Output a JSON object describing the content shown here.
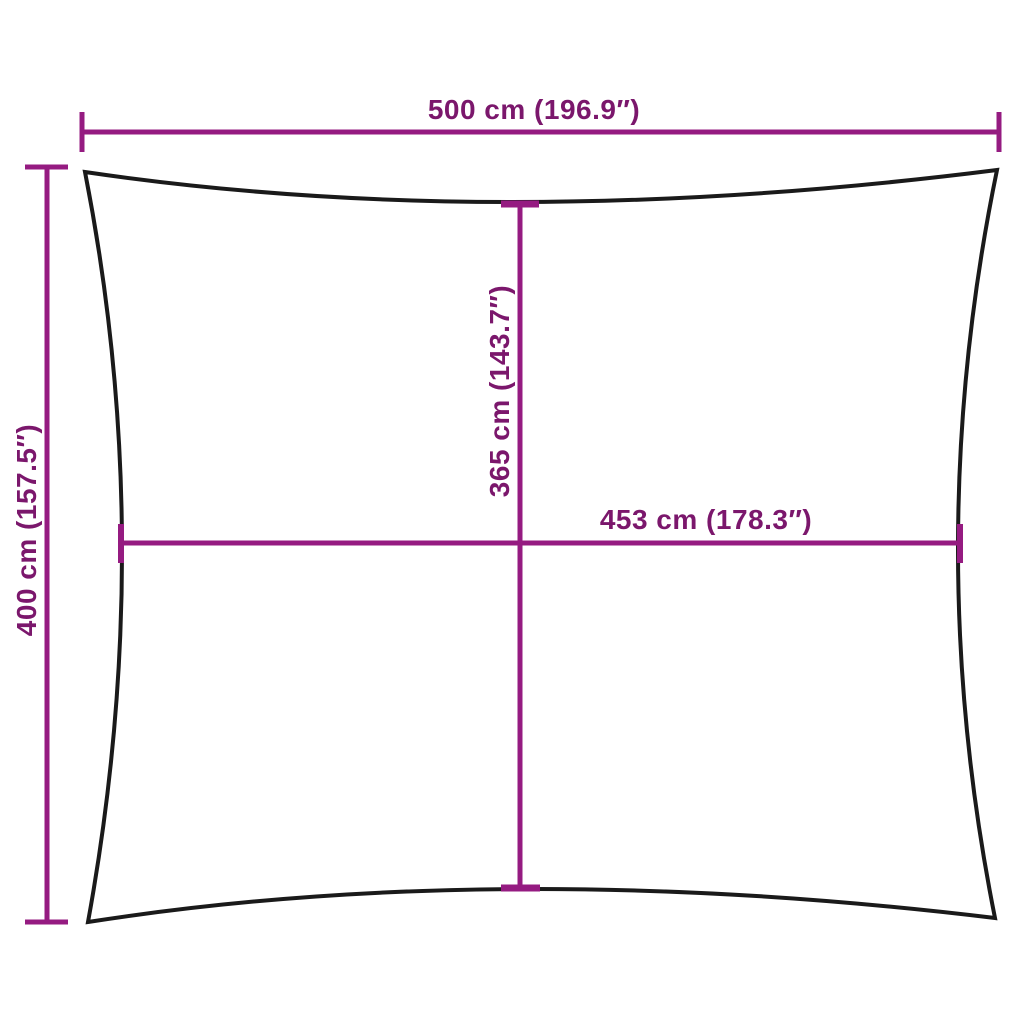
{
  "colors": {
    "background": "#FFFFFF",
    "dimension_line": "#951B81",
    "dimension_text": "#7B176C",
    "sail_outline": "#1A1A1A"
  },
  "diagram": {
    "subject": "rectangular shade sail with concave edges",
    "dimensions": {
      "width_top": {
        "label": "500 cm (196.9″)",
        "value_cm": 500,
        "value_in": 196.9
      },
      "height_left": {
        "label": "400 cm (157.5″)",
        "value_cm": 400,
        "value_in": 157.5
      },
      "height_center": {
        "label": "365 cm (143.7″)",
        "value_cm": 365,
        "value_in": 143.7
      },
      "width_center": {
        "label": "453 cm (178.3″)",
        "value_cm": 453,
        "value_in": 178.3
      }
    }
  }
}
